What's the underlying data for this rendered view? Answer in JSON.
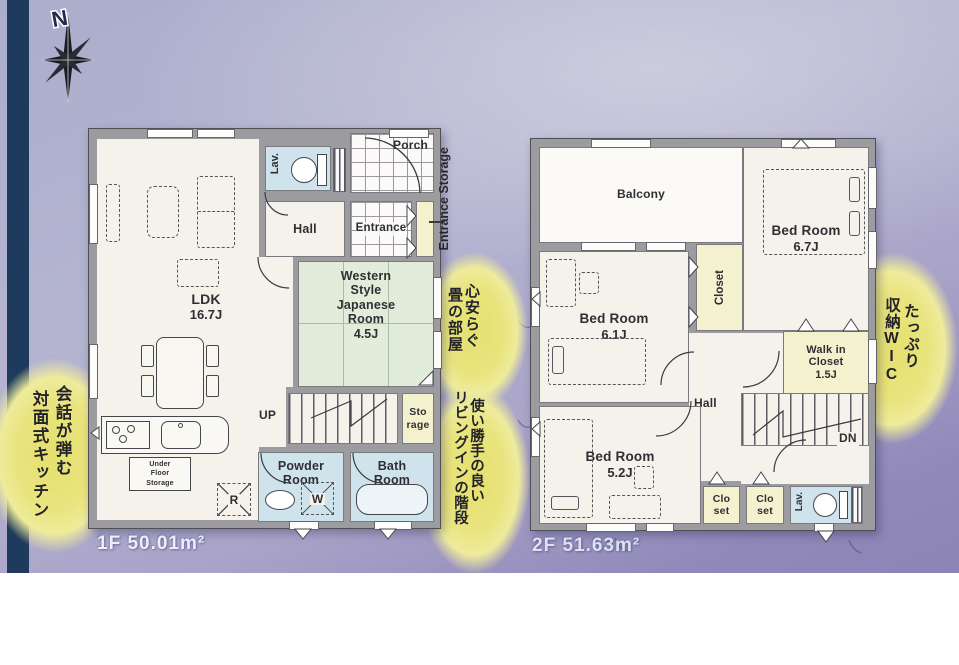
{
  "compass": {
    "north": "N"
  },
  "floor1": {
    "area_label": "1F 50.01m²",
    "rooms": {
      "ldk": {
        "name": "LDK",
        "size": "16.7J"
      },
      "western_room": {
        "name": "Western Style Japanese Room",
        "size": "4.5J"
      },
      "lav": "Lav.",
      "hall": "Hall",
      "entrance": "Entrance",
      "porch": "Porch",
      "entrance_storage": "Entrance Storage",
      "storage": "Sto rage",
      "powder_room": "Powder Room",
      "bath_room": "Bath Room",
      "under_floor_storage": "Under Floor Storage",
      "refrigerator": "R",
      "washer": "W",
      "stairs_up": "UP"
    }
  },
  "floor2": {
    "area_label": "2F 51.63m²",
    "rooms": {
      "balcony": "Balcony",
      "bedroom_a": {
        "name": "Bed Room",
        "size": "6.7J"
      },
      "bedroom_b": {
        "name": "Bed Room",
        "size": "6.1J"
      },
      "bedroom_c": {
        "name": "Bed Room",
        "size": "5.2J"
      },
      "closet": "Closet",
      "walk_in_closet": {
        "name": "Walk in Closet",
        "size": "1.5J"
      },
      "hall": "Hall",
      "closet_left": "Clo set",
      "closet_right": "Clo set",
      "lav": "Lav.",
      "stairs_down": "DN"
    }
  },
  "annotations": {
    "kitchen": {
      "col1": "会話が弾む",
      "col2": "対面式キッチン"
    },
    "tatami": {
      "col1": "心安らぐ",
      "col2": "畳の部屋"
    },
    "stairs": {
      "col1": "使い勝手の良い",
      "col2": "リビングインの階段"
    },
    "wic": {
      "col1": "たっぷり",
      "col2": "収納WIC"
    }
  },
  "colors": {
    "background_top": "#b5b5d1",
    "background_bottom": "#8d84b6",
    "navy_strip": "#1e3a5c",
    "wall_gray": "#9c9ca0",
    "room_white": "#f5f2ec",
    "water_blue": "#cfe3ed",
    "tatami_green": "#e2ecdb",
    "closet_yellow": "#f4f1cf",
    "highlight_yellow": "#e9e480"
  }
}
